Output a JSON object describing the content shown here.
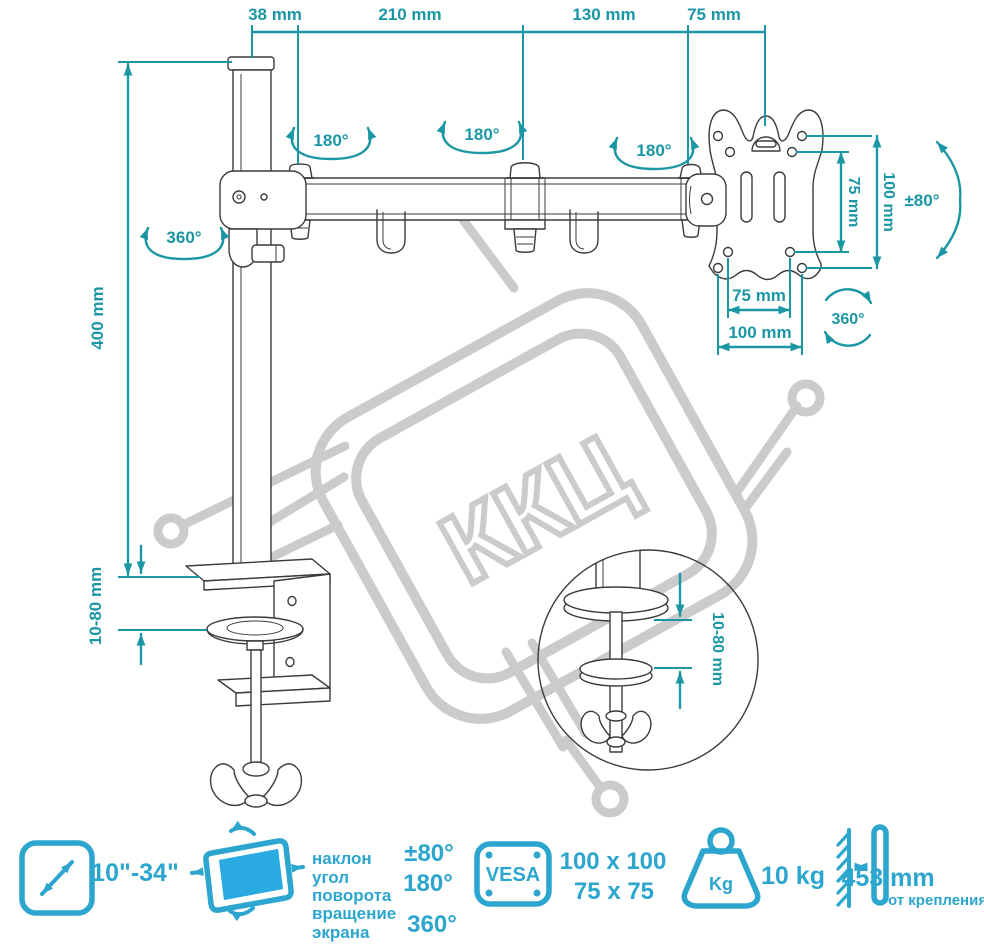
{
  "title": "Desk monitor arm technical drawing",
  "colors": {
    "dimension_teal": "#1B96A5",
    "legend_blue": "#2CA6CE",
    "screen_fill": "#29ABE2",
    "drawing_line": "#3b3b3b",
    "watermark_gray": "#cbcbcb"
  },
  "watermark": {
    "text": "ККЦ"
  },
  "dims": {
    "top38": "38 mm",
    "top210": "210 mm",
    "top130": "130 mm",
    "top75": "75 mm",
    "pole_height": "400 mm",
    "pole_swivel": "360°",
    "arm_rot1": "180°",
    "arm_rot2": "180°",
    "arm_rot3": "180°",
    "clamp_range": "10-80 mm",
    "vesa_v75": "75 mm",
    "vesa_v100": "100 mm",
    "vesa_tilt": "±80°",
    "vesa_h75": "75 mm",
    "vesa_h100": "100 mm",
    "vesa_rot": "360°",
    "detail_range": "10-80 mm"
  },
  "legend": {
    "screen_size": "10\"-34\"",
    "tilt_label1": "наклон",
    "tilt_label2": "угол",
    "tilt_label3": "поворота",
    "tilt_label4": "вращение",
    "tilt_label5": "экрана",
    "tilt_value": "±80°",
    "swivel_value": "180°",
    "rotate_value": "360°",
    "vesa_title": "VESA",
    "vesa_size1": "100 x 100",
    "vesa_size2": "75 x 75",
    "weight_unit": "Kg",
    "weight_value": "10 kg",
    "distance_value": "453 mm",
    "distance_caption": "от крепления"
  }
}
